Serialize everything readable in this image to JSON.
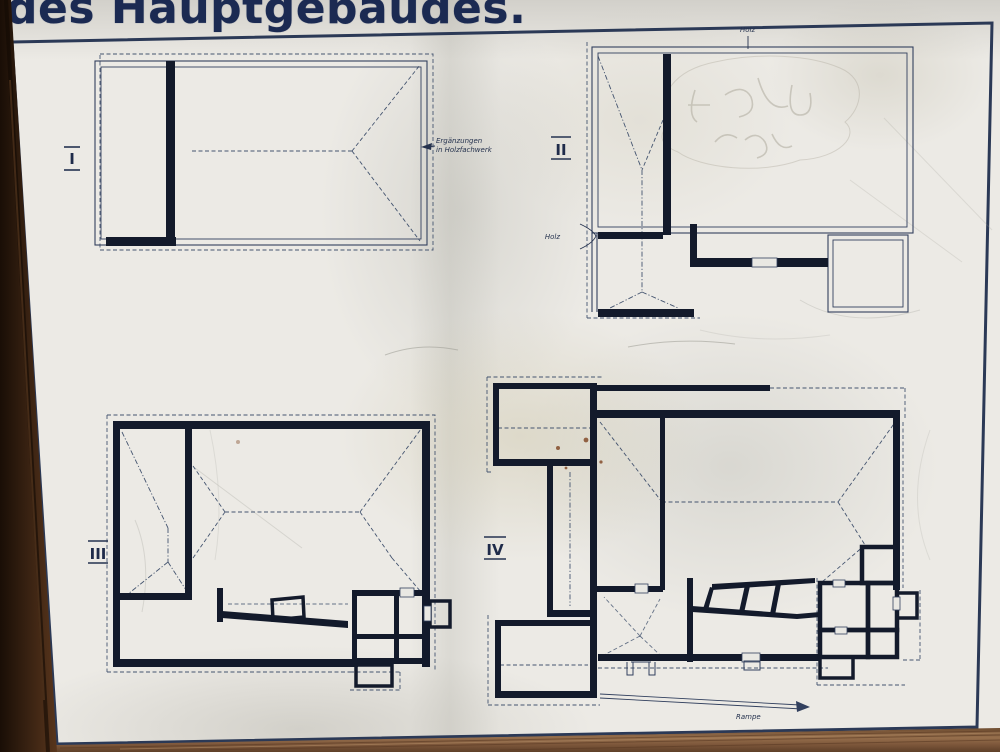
{
  "sign": {
    "title": "des Hauptgebäudes.",
    "plans": [
      {
        "numeral": "I"
      },
      {
        "numeral": "II"
      },
      {
        "numeral": "III"
      },
      {
        "numeral": "IV"
      }
    ],
    "annotations": {
      "erganzungen_line1": "Ergänzungen",
      "erganzungen_line2": "in Holzfachwerk",
      "holz_top": "Holz",
      "holz_left": "Holz",
      "rampe": "Rampe"
    },
    "colors": {
      "ink_walls": "#131a2b",
      "thin_line": "#32405e",
      "dashed_line": "#44546f",
      "panel_border": "#2b3956",
      "title_text": "#1b2a52",
      "paper": "#eceae5",
      "wood_dark": "#2a1a0e",
      "wood_light": "#95704e"
    }
  }
}
